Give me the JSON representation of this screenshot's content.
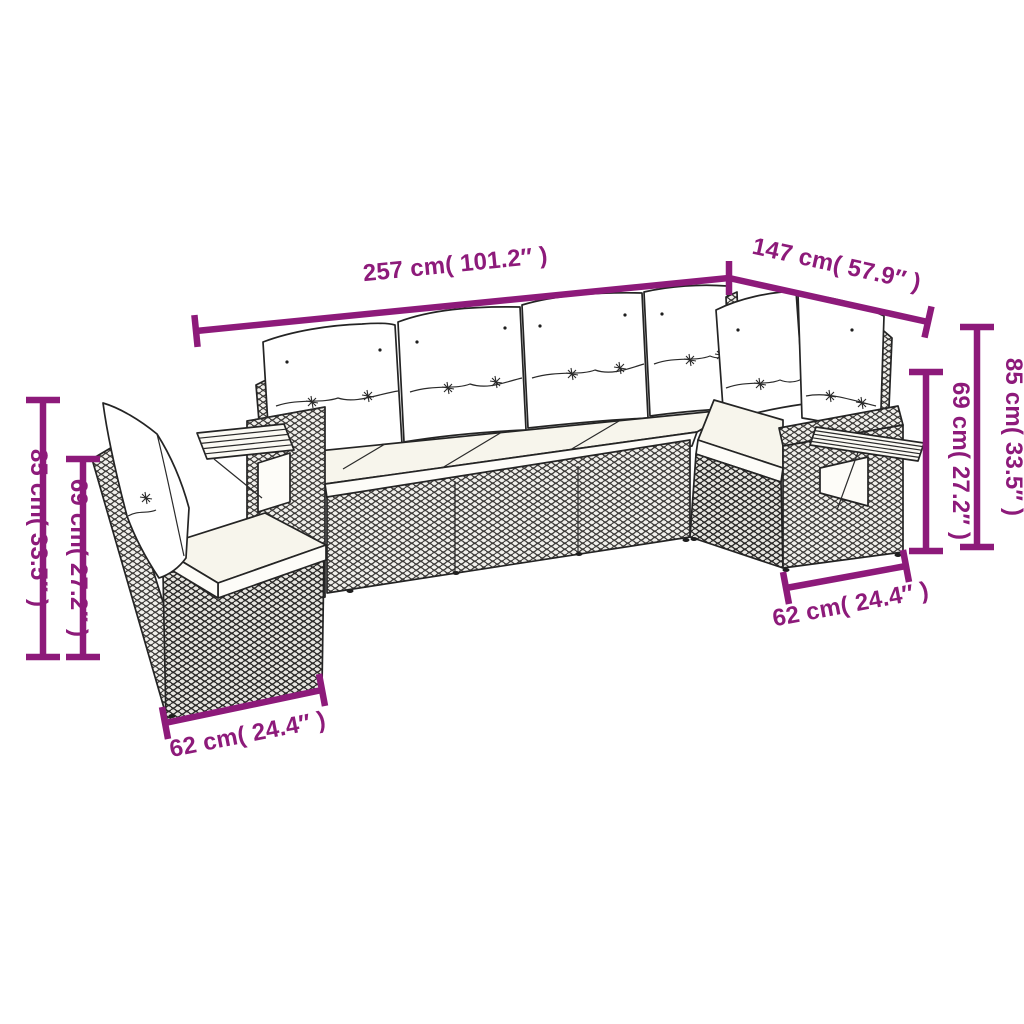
{
  "canvas": {
    "width": 1024,
    "height": 1024,
    "background": "#ffffff"
  },
  "style": {
    "accent_color": "#8d1a7a",
    "line_color": "#242424",
    "cushion_color": "#ffffff",
    "seat_cushion_color": "#f7f5ec"
  },
  "illustration": {
    "subject": "L-shaped rattan garden sofa set with back and seat cushions and two wooden armrest shelves"
  },
  "dimensions": {
    "top_width": "257 cm( 101.2″ )",
    "right_depth": "147 cm( 57.9″ )",
    "left_back_height": "85 cm( 33.5″ )",
    "left_arm_height": "69 cm( 27.2″ )",
    "left_base_width": "62 cm( 24.4″ )",
    "right_back_height": "85 cm( 33.5″ )",
    "right_arm_height": "69 cm( 27.2″ )",
    "right_base_width": "62 cm( 24.4″ )"
  }
}
